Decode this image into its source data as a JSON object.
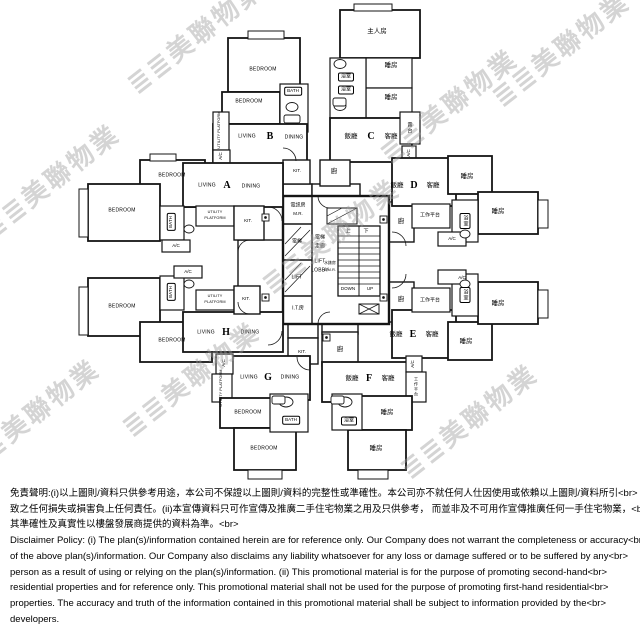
{
  "watermark": {
    "tile": "≣≣美聯物業",
    "color": "#9a9a9a"
  },
  "core": {
    "telecom_room": "電訊房",
    "telecom_room_abbr": "M.R.",
    "lift_zh": "電梯",
    "lift_en": "LIFT",
    "lobby_line1": "電梯",
    "lobby_line2": "走廊",
    "lobby_line3": "LIFT",
    "lobby_line4": "LOBBY",
    "meter_room": "水錶房",
    "meter_room_abbr": "A.M.R.",
    "stair_up_zh": "上",
    "stair_down_zh": "下",
    "stair_down_en": "DOWN",
    "stair_up_en": "UP",
    "it_room": "I.T.房"
  },
  "units": {
    "a": {
      "letter": "A",
      "living": "LIVING",
      "dining": "DINING",
      "bedroom1": "BEDROOM",
      "bedroom2": "BEDROOM",
      "bath": "BATH",
      "ac": "A/C",
      "utility1": "UTILITY",
      "utility2": "PLATFORM",
      "kitchen": "KIT."
    },
    "b": {
      "letter": "B",
      "living": "LIVING",
      "dining": "DINING",
      "bedroom1": "BEDROOM",
      "bedroom2": "BEDROOM",
      "bath": "BATH",
      "ac": "A/C",
      "utility": "UTILITY PLATFORM",
      "kitchen": "KIT."
    },
    "c": {
      "letter": "C",
      "dining": "飯廳",
      "living": "客廳",
      "master_bedroom": "主人房",
      "bedroom1": "睡房",
      "bedroom2": "睡房",
      "bath1": "浴室",
      "bath2": "浴室",
      "balcony": "露台",
      "ac": "A/C",
      "kitchen": "廚"
    },
    "d": {
      "letter": "D",
      "dining": "飯廳",
      "living": "客廳",
      "bedroom1": "睡房",
      "bedroom2": "睡房",
      "utility": "工作平台",
      "bath": "浴室",
      "ac": "A/C",
      "kitchen": "廚"
    },
    "e": {
      "letter": "E",
      "dining": "飯廳",
      "living": "客廳",
      "bedroom1": "睡房",
      "bedroom2": "睡房",
      "utility": "工作平台",
      "bath": "浴室",
      "ac": "A/C",
      "kitchen": "廚"
    },
    "f": {
      "letter": "F",
      "dining": "飯廳",
      "living": "客廳",
      "bedroom1": "睡房",
      "bedroom2": "睡房",
      "bath": "浴室",
      "utility": "工作平台",
      "ac": "A/C",
      "kitchen": "廚"
    },
    "g": {
      "letter": "G",
      "living": "LIVING",
      "dining": "DINING",
      "bedroom1": "BEDROOM",
      "bedroom2": "BEDROOM",
      "bath": "BATH",
      "ac": "A/C",
      "utility": "UTILITY PLATFORM",
      "kitchen": "KIT."
    },
    "h": {
      "letter": "H",
      "living": "LIVING",
      "dining": "DINING",
      "bedroom1": "BEDROOM",
      "bedroom2": "BEDROOM",
      "bath": "BATH",
      "ac": "A/C",
      "utility1": "UTILITY",
      "utility2": "PLATFORM",
      "kitchen": "KIT."
    }
  },
  "disclaimer": {
    "zh": [
      "免責聲明:(i)以上圖則/資料只供參考用途，本公司不保證以上圖則/資料的完整性或準確性。本公司亦不就任何人仕因使用或依賴以上圖則/資料所引<br>",
      "致之任何損失或損害負上任何責任。(ii)本宣傳資料只可作宣傳及推廣二手住宅物業之用及只供參考， 而並非及不可用作宣傳推廣任何一手住宅物業，<br>",
      "其準確性及真實性以樓盤發展商提供的資料為準。<br>"
    ],
    "en": [
      "Disclaimer Policy: (i) The plan(s)/information contained herein are for reference only. Our Company does not warrant the completeness or accuracy<br>",
      "of the above plan(s)/information. Our Company also disclaims any liability whatsoever for any loss or damage suffered or to be suffered by any<br>",
      "person as a result of using or relying on the plan(s)/information. (ii) This promotional material is for the purpose of promoting second-hand<br>",
      "residential properties and for reference only. This promotional material shall not be used for the purpose of promoting first-hand residential<br>",
      "properties. The accuracy and truth of the information contained in this promotional material shall be subject to information provided by the<br>",
      "developers."
    ]
  }
}
